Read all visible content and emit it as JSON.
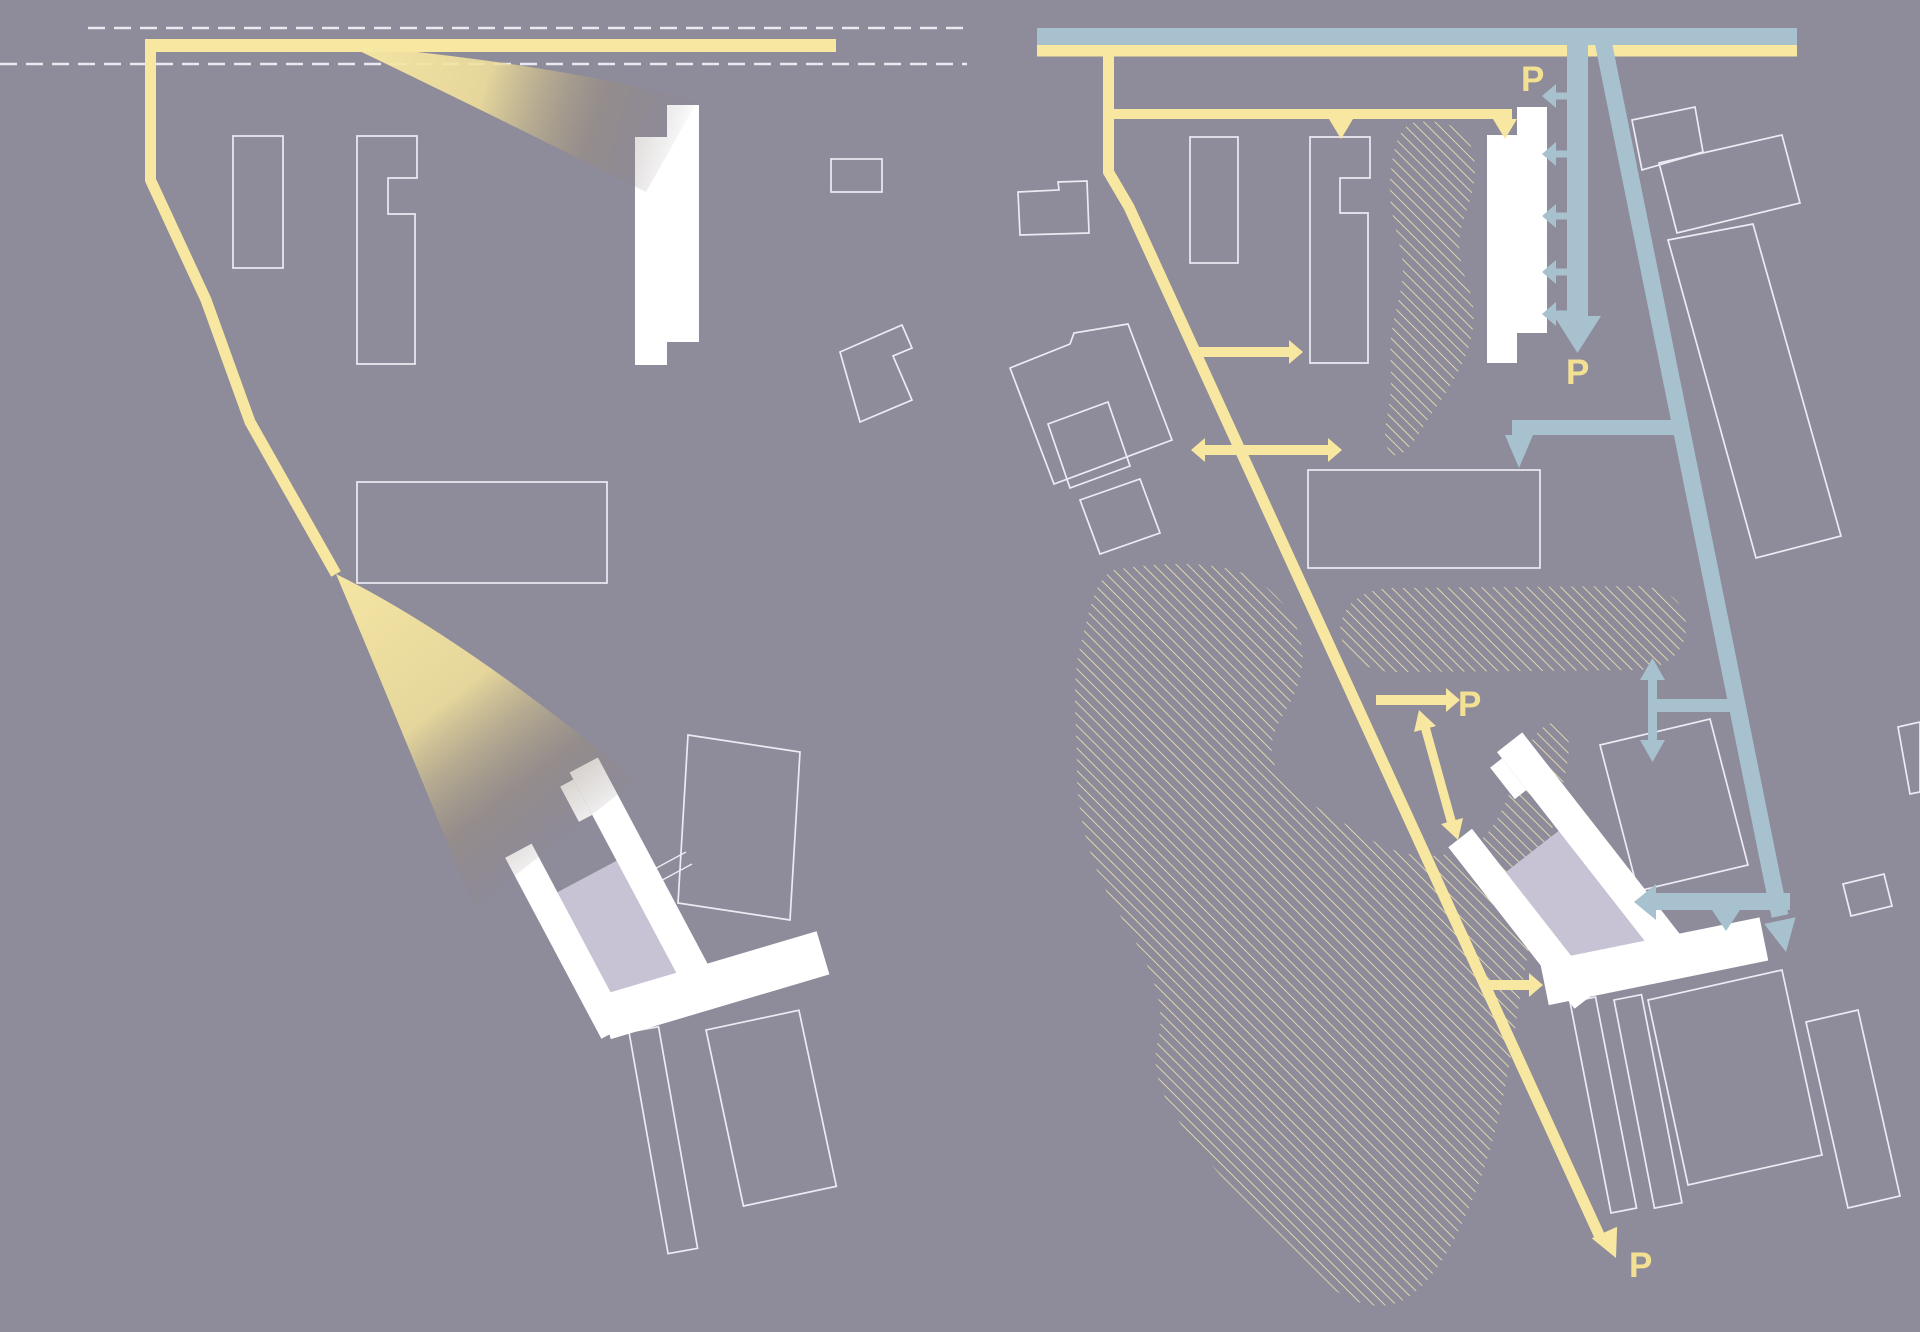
{
  "page": {
    "title": "Site circulation and view-cone diagram pair"
  },
  "panels": {
    "left": {
      "name": "site view cones diagram"
    },
    "right": {
      "name": "site circulation and parking diagram"
    }
  },
  "labels": {
    "parking": "P"
  },
  "colors": {
    "background": "#8e8b9a",
    "route_yellow": "#f8e7a0",
    "route_blue": "#a7c1ce",
    "building_white": "#ffffff",
    "building_outline": "#ecebf3",
    "hatch_cream": "#ddd6ae",
    "halftone_lavender": "#c7c3d4",
    "parking_label": "#f3e193",
    "setback_dash": "#e9e9f0"
  },
  "icons": {
    "arrowhead": "triangle-arrowhead",
    "double_arrow": "two-way-arrow",
    "chevron_left": "left-chevron-access-marker"
  }
}
